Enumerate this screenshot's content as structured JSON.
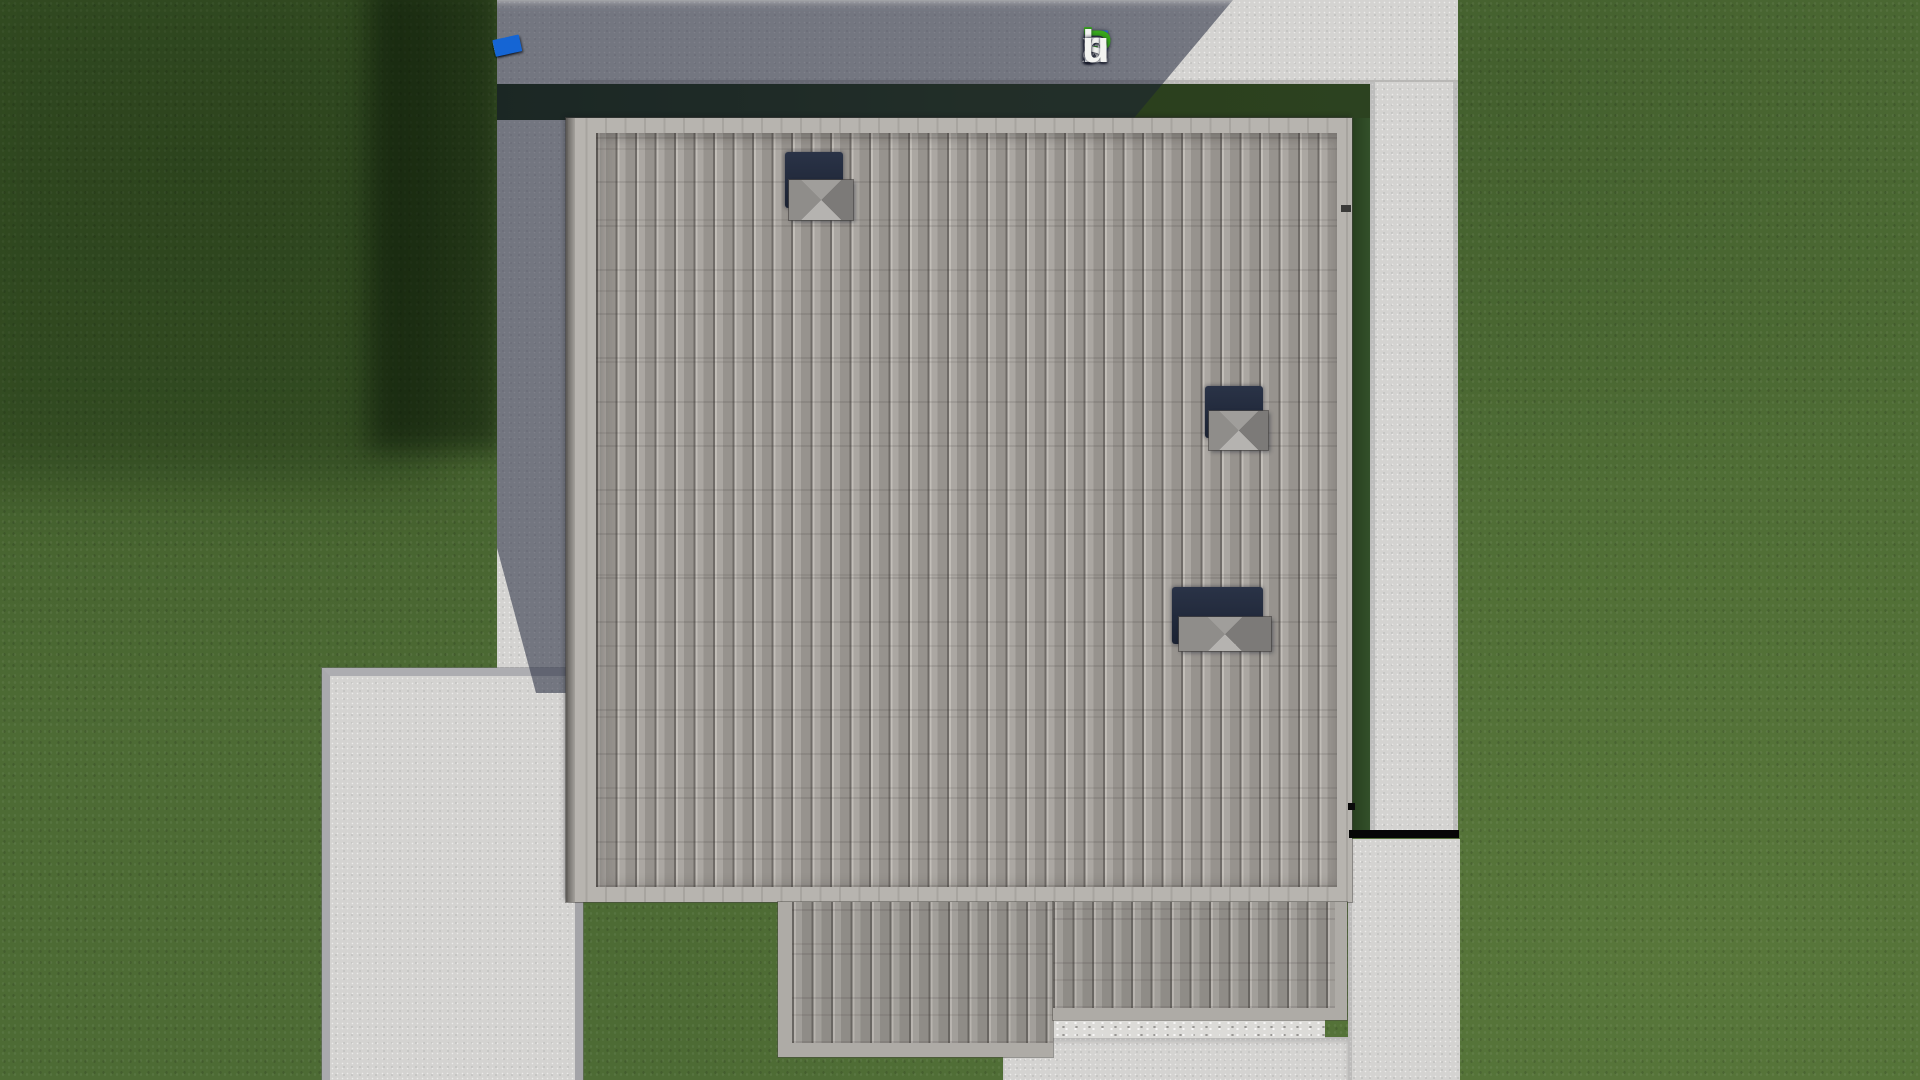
{
  "scene": {
    "type": "aerial-3d-render",
    "subject": "top-down aerial view of a house roof with lawn, concrete walkways, patios and driveway in shadow",
    "chimney_count": 3,
    "colors": {
      "lawn": "#4d6b34",
      "lawn_shadow": "#22350f",
      "concrete": "#d4d3d1",
      "concrete_in_shadow": "#6e7280",
      "roof_tile": "#a09c98",
      "roof_eave": "#b7b4af",
      "lower_roof_tile": "#9a9691",
      "chimney_body": "#202839",
      "chimney_cap": "#8d8b88",
      "step_marker": "#070707"
    }
  },
  "watermark": {
    "text": "FixPlans.ru",
    "letters": [
      {
        "char": "F",
        "color": "#2e6ad1"
      },
      {
        "char": "i",
        "color": "#f3f3f1",
        "dot_color": "#3bab1e"
      },
      {
        "char": "x",
        "color": "#f3f3f1"
      },
      {
        "char": "P",
        "color": "#38a51d"
      },
      {
        "char": "l",
        "color": "#f3f3f1"
      },
      {
        "char": "a",
        "color": "#f3f3f1"
      },
      {
        "char": "n",
        "color": "#f3f3f1"
      },
      {
        "char": "s",
        "color": "#f3f3f1"
      },
      {
        "char": ".",
        "color": "#2e6ad1"
      },
      {
        "char": "r",
        "color": "#f3f3f1"
      },
      {
        "char": "u",
        "color": "#f3f3f1"
      }
    ]
  },
  "fence": {
    "segments": [
      {
        "color": "#eaeae8",
        "w": 22,
        "h": 12
      },
      {
        "color": "#e6e6e4",
        "w": 24,
        "h": 12
      },
      {
        "color": "#1565d4",
        "w": 10,
        "h": 12
      },
      {
        "color": "#ededeb",
        "w": 18,
        "h": 12
      },
      {
        "color": "#e4e4e2",
        "w": 21,
        "h": 12
      },
      {
        "color": "#e9e9e7",
        "w": 20,
        "h": 11
      },
      {
        "color": "#efefed",
        "w": 18,
        "h": 11
      },
      {
        "color": "#3aa320",
        "w": 25,
        "h": 13
      },
      {
        "color": "#e8e8e6",
        "w": 24,
        "h": 12
      },
      {
        "color": "#3aa320",
        "w": 11,
        "h": 13
      },
      {
        "color": "#1565d4",
        "w": 27,
        "h": 17
      }
    ]
  }
}
